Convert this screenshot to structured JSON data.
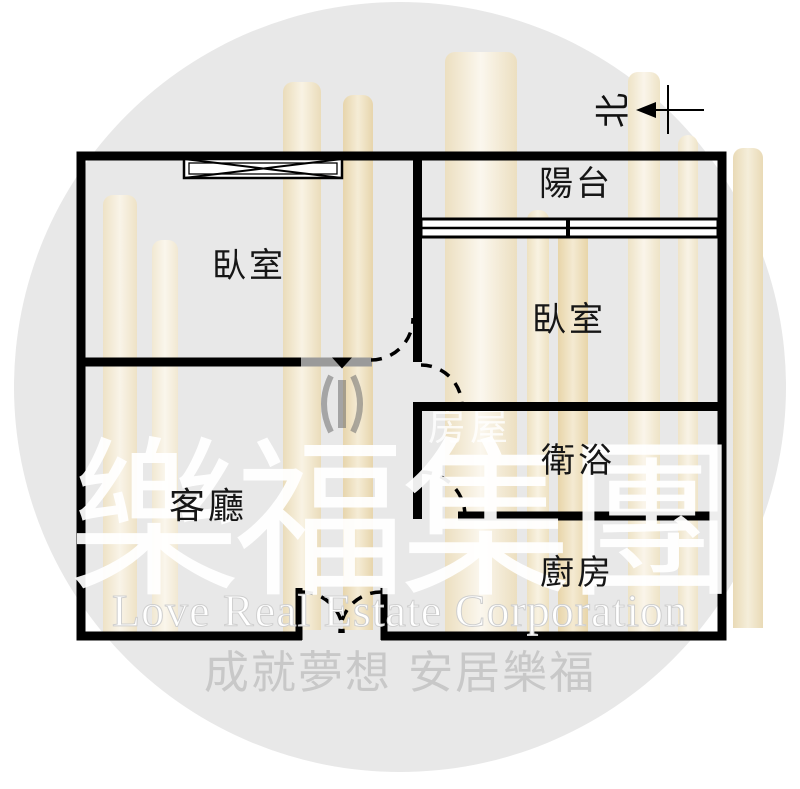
{
  "watermark": {
    "brand_cn": "樂福集團",
    "brand_en": "Love Real Estate Corporation",
    "slogan": "成就夢想 安居樂福",
    "logo_text": "房屋",
    "circle_color": "#e8e8e8",
    "brand_text_color": "#ffffff",
    "slogan_color": "#c8c8c8",
    "building_bar_color": "#f0e2c0"
  },
  "floor_plan": {
    "wall_color": "#000000",
    "gray_wall_color": "#9a9a9a",
    "north_label": "北",
    "rooms": [
      {
        "id": "bedroom-1",
        "label": "臥室"
      },
      {
        "id": "balcony",
        "label": "陽台"
      },
      {
        "id": "bedroom-2",
        "label": "臥室"
      },
      {
        "id": "bathroom",
        "label": "衛浴"
      },
      {
        "id": "kitchen",
        "label": "廚房"
      },
      {
        "id": "living-room",
        "label": "客廳"
      }
    ]
  }
}
